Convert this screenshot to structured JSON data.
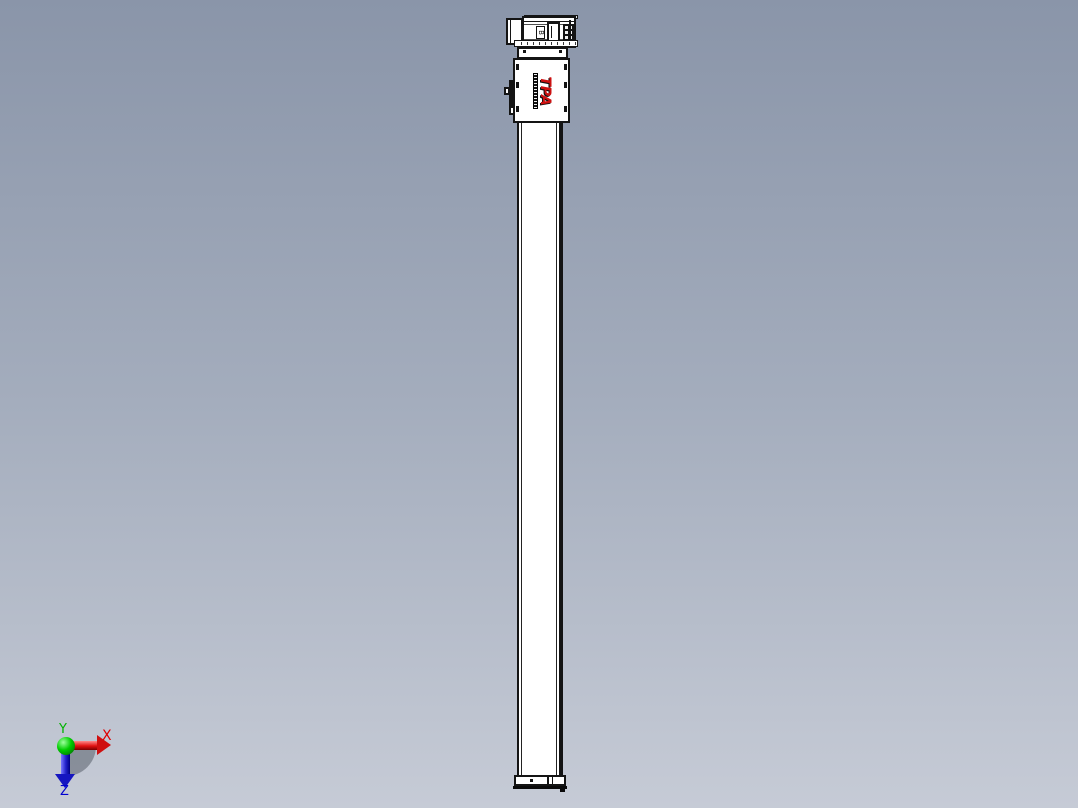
{
  "scene": {
    "description": "CAD preview of a vertical linear actuator module with top-mounted motor",
    "background_top_color": "#8a95a9",
    "background_bottom_color": "#c6cbd6"
  },
  "model": {
    "logo_text": "TPA",
    "logo_color": "#cc1111",
    "motor_nameplate": "B"
  },
  "triad": {
    "x_label": "X",
    "y_label": "Y",
    "z_label": "Z",
    "x_color": "#e00000",
    "y_color": "#00b400",
    "z_color": "#0000d0"
  }
}
